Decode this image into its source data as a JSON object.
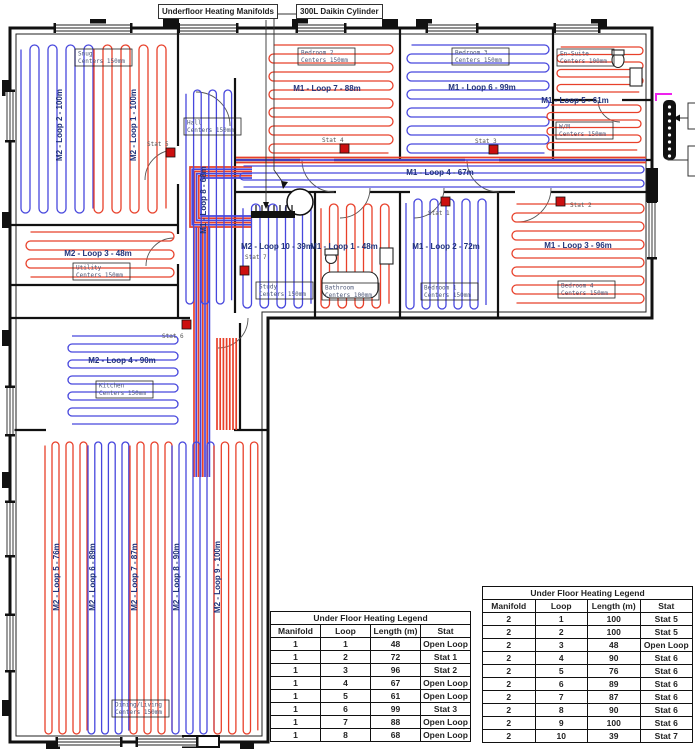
{
  "callouts": {
    "manifolds": "Underfloor Heating Manifolds",
    "cylinder": "300L Daikin Cylinder"
  },
  "colors": {
    "red": "#e8402a",
    "blue": "#4747dd",
    "stat": "#cc1010",
    "magenta": "#ee22ee",
    "loop_text": "#20327a"
  },
  "rooms": [
    {
      "name": "Snug",
      "centers": "Centers 150mm",
      "x": 75,
      "y": 49
    },
    {
      "name": "Hall",
      "centers": "Centers 150mm",
      "x": 184,
      "y": 118
    },
    {
      "name": "Bedroom 2",
      "centers": "Centers 150mm",
      "x": 298,
      "y": 48
    },
    {
      "name": "Bedroom 3",
      "centers": "Centers 150mm",
      "x": 452,
      "y": 48
    },
    {
      "name": "En-Suite",
      "centers": "Centers 100mm",
      "x": 557,
      "y": 49
    },
    {
      "name": "W/M",
      "centers": "Centers 150mm",
      "x": 556,
      "y": 122
    },
    {
      "name": "Study",
      "centers": "Centers 150mm",
      "x": 256,
      "y": 282
    },
    {
      "name": "Bathroom",
      "centers": "Centers 100mm",
      "x": 322,
      "y": 283
    },
    {
      "name": "Bedroom 1",
      "centers": "Centers 150mm",
      "x": 421,
      "y": 283
    },
    {
      "name": "Bedroom 4",
      "centers": "Centers 150mm",
      "x": 558,
      "y": 281
    },
    {
      "name": "Utility",
      "centers": "Centers 150mm",
      "x": 73,
      "y": 263
    },
    {
      "name": "Kitchen",
      "centers": "Centers 150mm",
      "x": 96,
      "y": 381
    },
    {
      "name": "Dining/Living",
      "centers": "Centers 150mm",
      "x": 112,
      "y": 700
    }
  ],
  "loop_labels": [
    {
      "text": "M2 - Loop 2 - 100m",
      "x": 62,
      "y": 125,
      "rot": -90
    },
    {
      "text": "M2 - Loop 1 - 100m",
      "x": 136,
      "y": 125,
      "rot": -90
    },
    {
      "text": "M1 - Loop 8 - 68m",
      "x": 206,
      "y": 200,
      "rot": -90
    },
    {
      "text": "M1 - Loop 7 - 88m",
      "x": 327,
      "y": 91,
      "rot": 0
    },
    {
      "text": "M1 - Loop 6 - 99m",
      "x": 482,
      "y": 90,
      "rot": 0
    },
    {
      "text": "M1 - Loop 5 - 61m",
      "x": 575,
      "y": 103,
      "rot": 0
    },
    {
      "text": "M1 - Loop 4 - 67m",
      "x": 440,
      "y": 175,
      "rot": 0
    },
    {
      "text": "M2 - Loop 10 - 39m",
      "x": 277,
      "y": 249,
      "rot": 0
    },
    {
      "text": "M1 - Loop 1 - 48m",
      "x": 344,
      "y": 249,
      "rot": 0
    },
    {
      "text": "M1 - Loop 2 - 72m",
      "x": 446,
      "y": 249,
      "rot": 0
    },
    {
      "text": "M1 - Loop 3 - 96m",
      "x": 578,
      "y": 248,
      "rot": 0
    },
    {
      "text": "M2 - Loop 3 - 48m",
      "x": 98,
      "y": 256,
      "rot": 0
    },
    {
      "text": "M2 - Loop 4 - 90m",
      "x": 122,
      "y": 363,
      "rot": 0
    },
    {
      "text": "M2 - Loop 5 - 76m",
      "x": 59,
      "y": 577,
      "rot": -90
    },
    {
      "text": "M2 - Loop 6 - 89m",
      "x": 95,
      "y": 577,
      "rot": -90
    },
    {
      "text": "M2 - Loop 7 - 87m",
      "x": 137,
      "y": 577,
      "rot": -90
    },
    {
      "text": "M2 - Loop 8 - 90m",
      "x": 179,
      "y": 577,
      "rot": -90
    },
    {
      "text": "M2 - Loop 9 - 100m",
      "x": 220,
      "y": 577,
      "rot": -90
    }
  ],
  "stats": [
    {
      "label": "Stat 5",
      "bx": 166,
      "by": 148,
      "tx": 147,
      "ty": 146
    },
    {
      "label": "Stat 4",
      "bx": 340,
      "by": 144,
      "tx": 322,
      "ty": 142
    },
    {
      "label": "Stat 3",
      "bx": 489,
      "by": 145,
      "tx": 475,
      "ty": 143
    },
    {
      "label": "Stat 1",
      "bx": 441,
      "by": 197,
      "tx": 428,
      "ty": 215
    },
    {
      "label": "Stat 2",
      "bx": 556,
      "by": 197,
      "tx": 570,
      "ty": 207
    },
    {
      "label": "Stat 7",
      "bx": 240,
      "by": 266,
      "tx": 245,
      "ty": 259
    },
    {
      "label": "Stat 6",
      "bx": 182,
      "by": 320,
      "tx": 162,
      "ty": 338
    }
  ],
  "serpentines": [
    {
      "x": 21,
      "y": 45,
      "w": 72,
      "h": 168,
      "dir": "v",
      "s": 9,
      "c": "blue"
    },
    {
      "x": 94,
      "y": 45,
      "w": 76,
      "h": 168,
      "dir": "v",
      "s": 9,
      "c": "red"
    },
    {
      "x": 186,
      "y": 90,
      "w": 46,
      "h": 214,
      "dir": "v",
      "s": 7.6,
      "c": "blue"
    },
    {
      "x": 269,
      "y": 45,
      "w": 124,
      "h": 110,
      "dir": "h",
      "s": 9,
      "c": "red"
    },
    {
      "x": 407,
      "y": 45,
      "w": 142,
      "h": 110,
      "dir": "h",
      "s": 9,
      "c": "blue"
    },
    {
      "x": 557,
      "y": 47,
      "w": 86,
      "h": 46,
      "dir": "h",
      "s": 7.5,
      "c": "red"
    },
    {
      "x": 547,
      "y": 105,
      "w": 94,
      "h": 52,
      "dir": "h",
      "s": 7.5,
      "c": "red"
    },
    {
      "x": 240,
      "y": 166,
      "w": 404,
      "h": 22,
      "dir": "h",
      "s": 7,
      "c": "blue"
    },
    {
      "x": 243,
      "y": 204,
      "w": 70,
      "h": 104,
      "dir": "v",
      "s": 8.5,
      "c": "blue"
    },
    {
      "x": 321,
      "y": 204,
      "w": 76,
      "h": 104,
      "dir": "v",
      "s": 8.5,
      "c": "red"
    },
    {
      "x": 406,
      "y": 199,
      "w": 86,
      "h": 110,
      "dir": "v",
      "s": 8,
      "c": "blue"
    },
    {
      "x": 512,
      "y": 204,
      "w": 132,
      "h": 104,
      "dir": "h",
      "s": 9,
      "c": "red"
    },
    {
      "x": 26,
      "y": 232,
      "w": 148,
      "h": 46,
      "dir": "h",
      "s": 9,
      "c": "red"
    },
    {
      "x": 68,
      "y": 336,
      "w": 110,
      "h": 88,
      "dir": "h",
      "s": 8,
      "c": "blue"
    },
    {
      "x": 45,
      "y": 442,
      "w": 42,
      "h": 292,
      "dir": "v",
      "s": 7,
      "c": "red"
    },
    {
      "x": 88,
      "y": 442,
      "w": 41,
      "h": 292,
      "dir": "v",
      "s": 6.8,
      "c": "blue"
    },
    {
      "x": 130,
      "y": 442,
      "w": 42,
      "h": 292,
      "dir": "v",
      "s": 7,
      "c": "red"
    },
    {
      "x": 172,
      "y": 442,
      "w": 42,
      "h": 292,
      "dir": "v",
      "s": 7,
      "c": "blue"
    },
    {
      "x": 214,
      "y": 442,
      "w": 44,
      "h": 292,
      "dir": "v",
      "s": 7.3,
      "c": "red"
    }
  ],
  "bundles": {
    "corridor": {
      "x0": 236,
      "x1": 646,
      "y": 157.5,
      "gap": 2.5,
      "colors": [
        "red",
        "blue",
        "red"
      ]
    },
    "nest": {
      "xr": 252,
      "xl": 190,
      "y0": 167,
      "y1": 227,
      "n": 6,
      "gap": 2.2
    },
    "drop": {
      "x": 194,
      "y0": 227,
      "y1": 477,
      "n": 8,
      "gap": 2.2
    },
    "kitchen": {
      "x": 217,
      "y0": 338,
      "y1": 430,
      "n": 7,
      "gap": 3.2
    },
    "magenta_path": "M672 94 H656 V101"
  },
  "legends": [
    {
      "x": 270,
      "y": 611,
      "w": 201,
      "title": "Under Floor Heating Legend",
      "headers": [
        "Manifold",
        "Loop",
        "Length (m)",
        "Stat"
      ],
      "rows": [
        [
          "1",
          "1",
          "48",
          "Open Loop"
        ],
        [
          "1",
          "2",
          "72",
          "Stat 1"
        ],
        [
          "1",
          "3",
          "96",
          "Stat 2"
        ],
        [
          "1",
          "4",
          "67",
          "Open Loop"
        ],
        [
          "1",
          "5",
          "61",
          "Open Loop"
        ],
        [
          "1",
          "6",
          "99",
          "Stat 3"
        ],
        [
          "1",
          "7",
          "88",
          "Open Loop"
        ],
        [
          "1",
          "8",
          "68",
          "Open Loop"
        ]
      ]
    },
    {
      "x": 482,
      "y": 586,
      "w": 211,
      "title": "Under Floor Heating Legend",
      "headers": [
        "Manifold",
        "Loop",
        "Length (m)",
        "Stat"
      ],
      "rows": [
        [
          "2",
          "1",
          "100",
          "Stat 5"
        ],
        [
          "2",
          "2",
          "100",
          "Stat 5"
        ],
        [
          "2",
          "3",
          "48",
          "Open Loop"
        ],
        [
          "2",
          "4",
          "90",
          "Stat 6"
        ],
        [
          "2",
          "5",
          "76",
          "Stat 6"
        ],
        [
          "2",
          "6",
          "89",
          "Stat 6"
        ],
        [
          "2",
          "7",
          "87",
          "Stat 6"
        ],
        [
          "2",
          "8",
          "90",
          "Stat 6"
        ],
        [
          "2",
          "9",
          "100",
          "Stat 6"
        ],
        [
          "2",
          "10",
          "39",
          "Stat 7"
        ]
      ]
    }
  ]
}
